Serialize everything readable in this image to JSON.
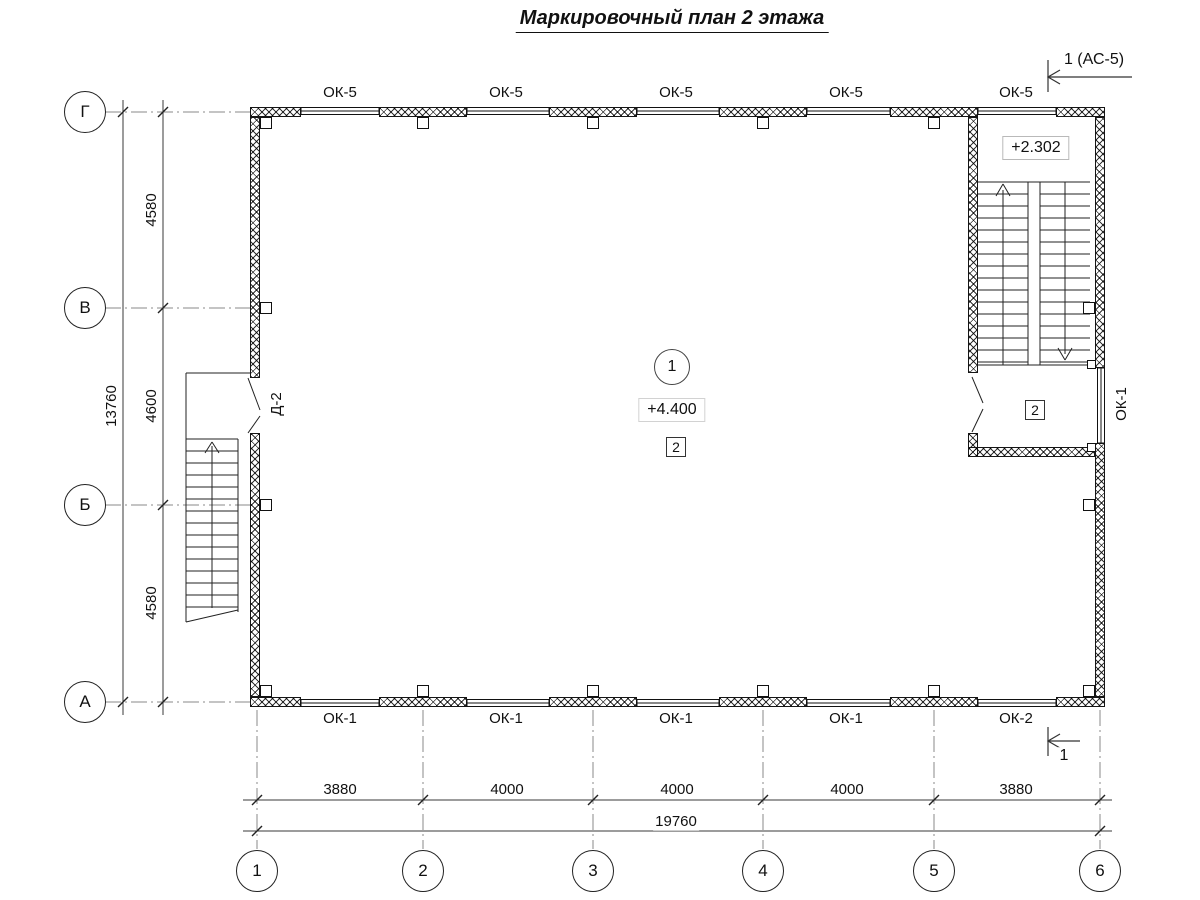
{
  "title": "Маркировочный план 2 этажа",
  "marks": {
    "section_top": "1 (АС-5)",
    "section_bottom": "1"
  },
  "axes": {
    "bottom": [
      "1",
      "2",
      "3",
      "4",
      "5",
      "6"
    ],
    "left": [
      "Г",
      "В",
      "Б",
      "А"
    ]
  },
  "dims": {
    "bottom_segments": [
      "3880",
      "4000",
      "4000",
      "4000",
      "3880"
    ],
    "bottom_total": "19760",
    "left_segments": [
      "4580",
      "4600",
      "4580"
    ],
    "left_total": "13760"
  },
  "windows": {
    "top": [
      "ОК-5",
      "ОК-5",
      "ОК-5",
      "ОК-5",
      "ОК-5"
    ],
    "bottom": [
      "ОК-1",
      "ОК-1",
      "ОК-1",
      "ОК-1",
      "ОК-2"
    ],
    "right": "ОК-1"
  },
  "doors": {
    "left": "Д-2"
  },
  "hall": {
    "room_number": "1",
    "elevation": "+4.400",
    "finish_tag": "2"
  },
  "stairwell": {
    "elevation": "+2.302",
    "finish_tag": "2"
  },
  "colors": {
    "line": "#1a1a1a",
    "axis_line": "#8a8a8a",
    "background": "#ffffff"
  }
}
